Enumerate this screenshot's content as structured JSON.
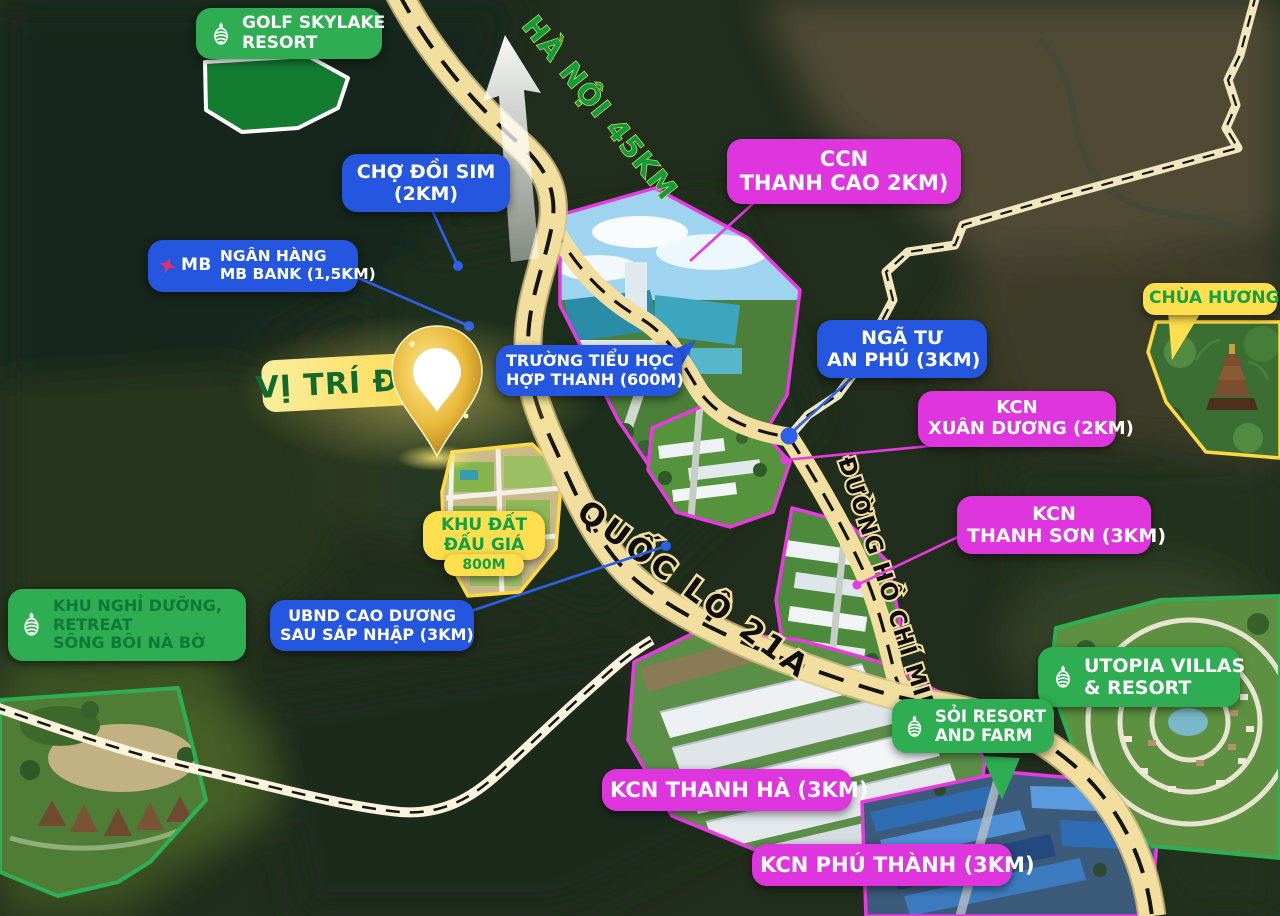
{
  "colors": {
    "badge_blue": "#2456df",
    "badge_magenta": "#df35df",
    "badge_green": "#2fad52",
    "badge_yellow": "#ffdf4d",
    "road_fill": "#f2dfa0",
    "road_thin_fill": "#f7eecf",
    "site_text_green": "#14692e",
    "direction_text_green": "#129a3c",
    "pin_gold": "#e8b83a"
  },
  "direction": {
    "label": "HÀ NỘI 45KM"
  },
  "roads": {
    "ql21a": "QUỐC LỘ 21A",
    "ho_chi_minh": "ĐƯỜNG HỒ CHÍ MINH"
  },
  "site": {
    "label": "VỊ TRÍ ĐẤT"
  },
  "auction": {
    "line1": "KHU ĐẤT",
    "line2": "ĐẤU GIÁ",
    "distance": "800M"
  },
  "badges": {
    "golf_skylake": {
      "line1": "GOLF SKYLAKE",
      "line2": "RESORT"
    },
    "cho_doi_sim": {
      "line1": "CHỢ ĐỒI SIM",
      "line2": "(2KM)"
    },
    "mb_bank": {
      "logo": "MB",
      "line1": "NGÂN HÀNG",
      "line2": "MB BANK (1,5KM)"
    },
    "ccn_thanh_cao": {
      "line1": "CCN",
      "line2": "THANH CAO 2KM)"
    },
    "chua_huong": {
      "label": "CHÙA HƯƠNG"
    },
    "nga_tu_an_phu": {
      "line1": "NGÃ TƯ",
      "line2": "AN PHÚ (3KM)"
    },
    "truong_tieu_hoc": {
      "line1": "TRƯỜNG TIỂU HỌC",
      "line2": "HỢP THANH (600M)"
    },
    "kcn_xuan_duong": {
      "line1": "KCN",
      "line2": "XUÂN DƯƠNG (2KM)"
    },
    "kcn_thanh_son": {
      "line1": "KCN",
      "line2": "THANH SƠN (3KM)"
    },
    "ubnd_cao_duong": {
      "line1": "UBND CAO DƯƠNG",
      "line2": "SAU SÁP NHẬP (3KM)"
    },
    "khu_nghi_duong": {
      "line1": "KHU NGHỈ DƯỠNG,",
      "line2": "RETREAT",
      "line3": "SÔNG BÔI NÀ BỜ"
    },
    "utopia": {
      "line1": "UTOPIA  VILLAS",
      "line2": "& RESORT"
    },
    "soi_resort": {
      "line1": "SỎI RESORT",
      "line2": "AND FARM"
    },
    "kcn_thanh_ha": {
      "label": "KCN THANH HÀ (3KM)"
    },
    "kcn_phu_thanh": {
      "label": "KCN PHÚ THÀNH (3KM)"
    }
  }
}
